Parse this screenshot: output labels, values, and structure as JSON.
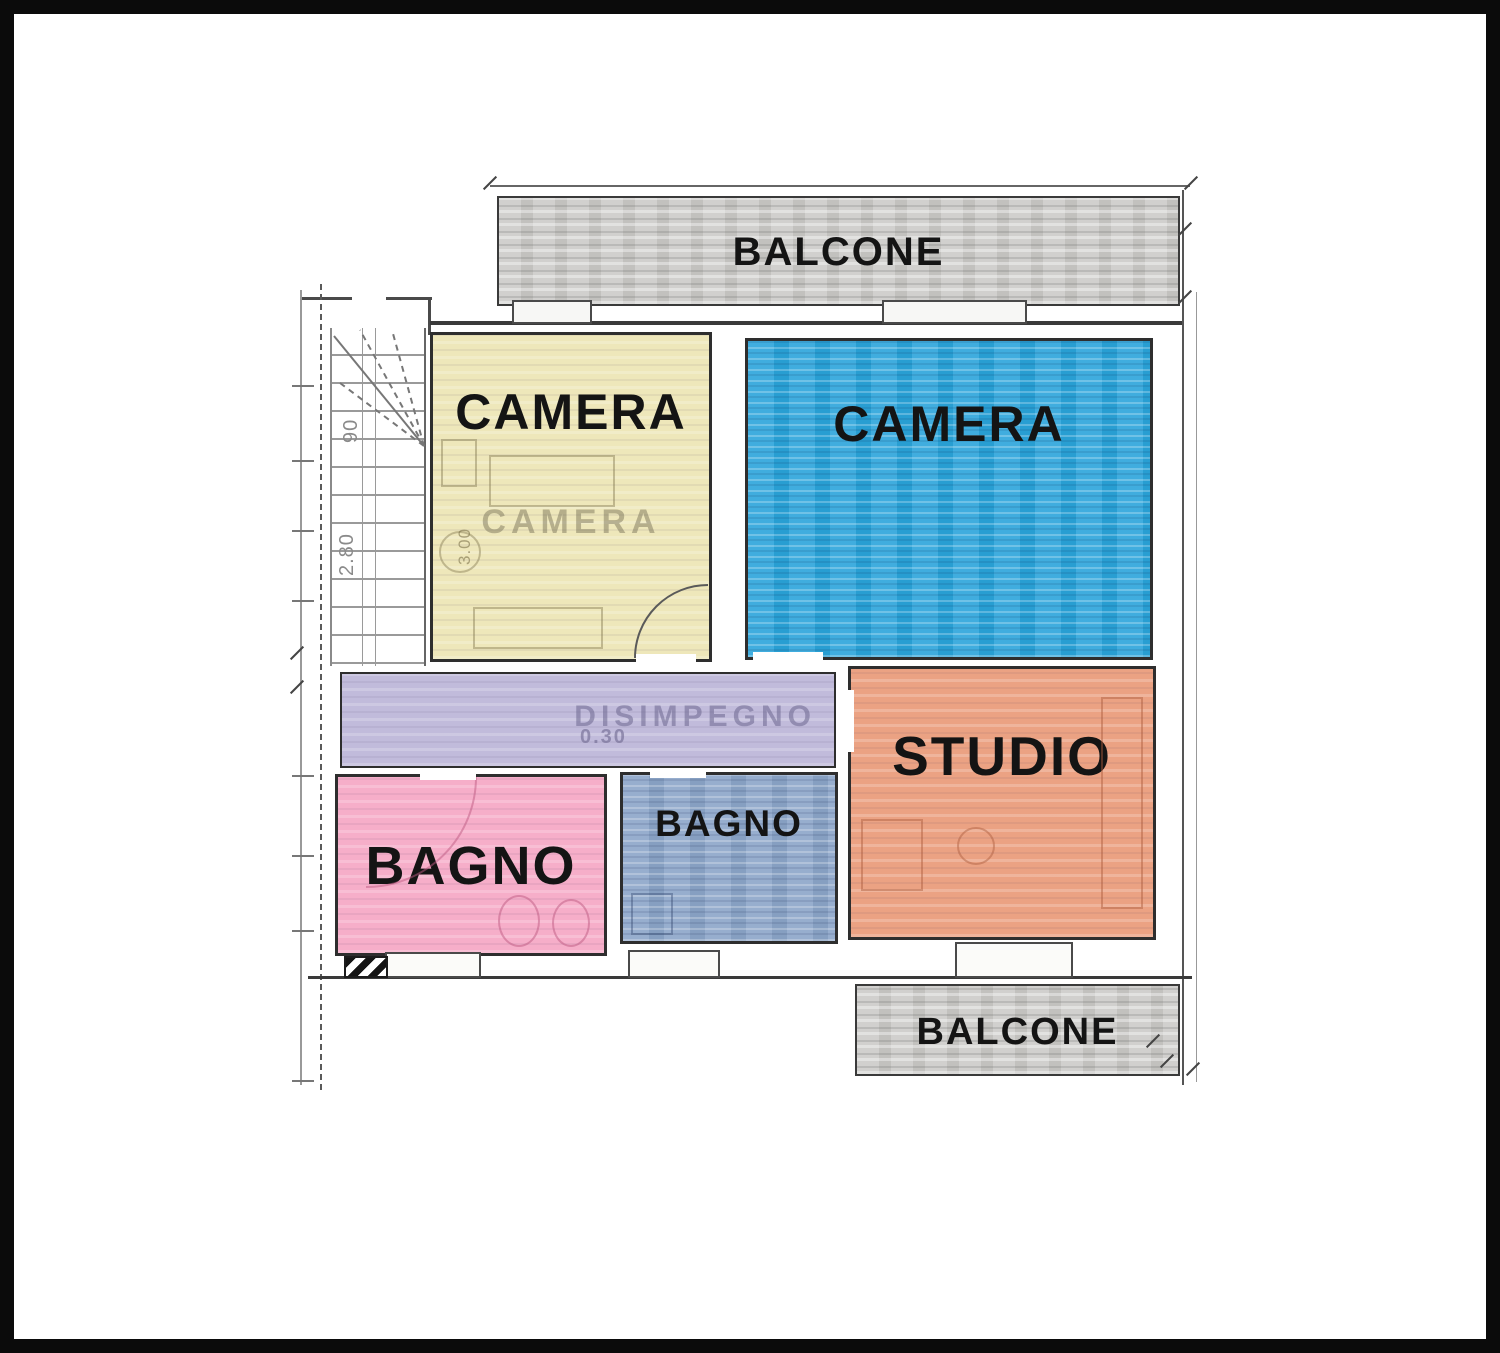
{
  "colors": {
    "frame": "#0b0b0b",
    "wall": "#3a3a3a",
    "balcony_fill": "#cccbc8",
    "camera_yellow_fill": "#eee7ba",
    "camera_blue_fill": "#2aa4db",
    "corridor_fill": "#c1bbdb",
    "bagno_pink_fill": "#f6aec9",
    "bagno_slate_fill": "#8ba5c9",
    "studio_fill": "#eba283",
    "label_ink": "#141414"
  },
  "rooms": {
    "balcone_top": {
      "label": "BALCONE"
    },
    "camera_yellow": {
      "label": "CAMERA",
      "watermark": "CAMERA",
      "dim": "3.00"
    },
    "camera_blue": {
      "label": "CAMERA"
    },
    "disimpegno": {
      "watermark": "DISIMPEGNO",
      "dim": "0.30"
    },
    "bagno_pink": {
      "label": "BAGNO"
    },
    "bagno_slate": {
      "label": "BAGNO"
    },
    "studio": {
      "label": "STUDIO"
    },
    "balcone_bottom": {
      "label": "BALCONE"
    }
  },
  "stairs": {
    "width_dim": "90",
    "height_dim": "2.80"
  }
}
